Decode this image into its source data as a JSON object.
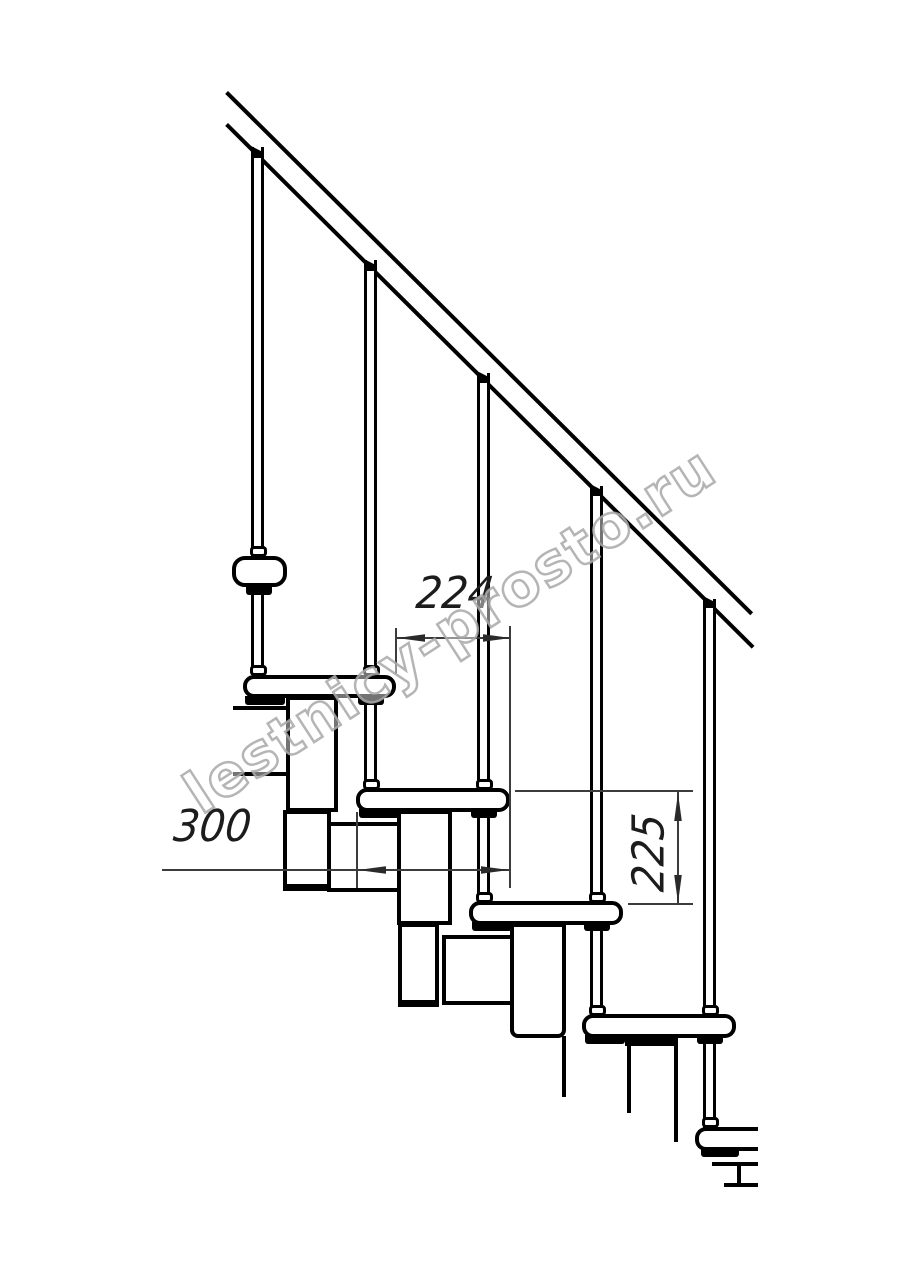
{
  "title": "Modular staircase side-view technical drawing",
  "watermark": {
    "text": "lestnicy-prosto.ru"
  },
  "dimensions": {
    "going": {
      "value": "224",
      "orientation": "horizontal"
    },
    "tread_depth": {
      "value": "300",
      "orientation": "horizontal"
    },
    "riser": {
      "value": "225",
      "orientation": "vertical"
    }
  },
  "colors": {
    "line": "#000000",
    "dimension_line": "#3c3c3c",
    "watermark": "#a8a8a8",
    "background": "#ffffff"
  }
}
